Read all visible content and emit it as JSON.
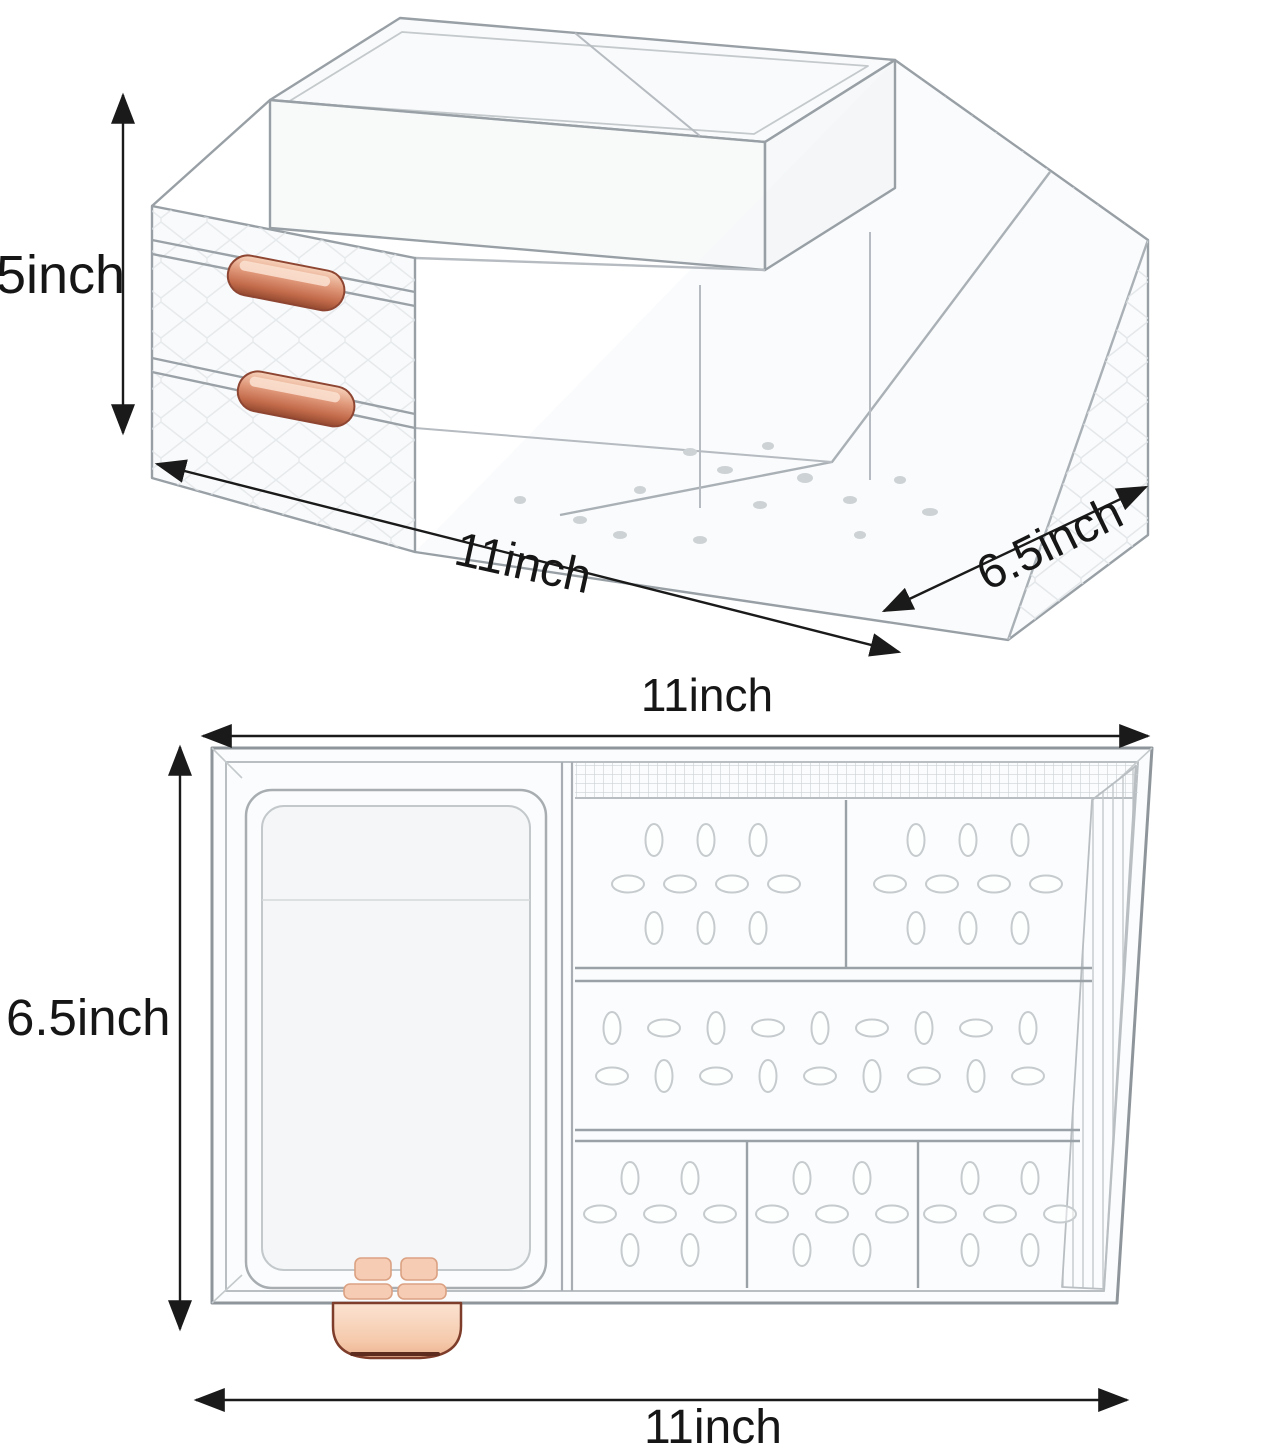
{
  "annotations": {
    "view_perspective": {
      "height_label": "5inch",
      "width_label": "11inch",
      "depth_label": "6.5inch"
    },
    "view_top_down": {
      "width_top_label": "11inch",
      "depth_label": "6.5inch",
      "width_bottom_label": "11inch"
    }
  },
  "colors": {
    "background": "#ffffff",
    "dimension_text": "#161616",
    "arrow": "#1a1a1a",
    "plastic_outline": "#98a0a6",
    "plastic_outline_light": "#c4c9cc",
    "handle_copper": "#c87police",
    "handle_copper_light": "#f4c5a9",
    "handle_copper_dark": "#8e4632",
    "handle_peach": "#f6cdb4"
  }
}
